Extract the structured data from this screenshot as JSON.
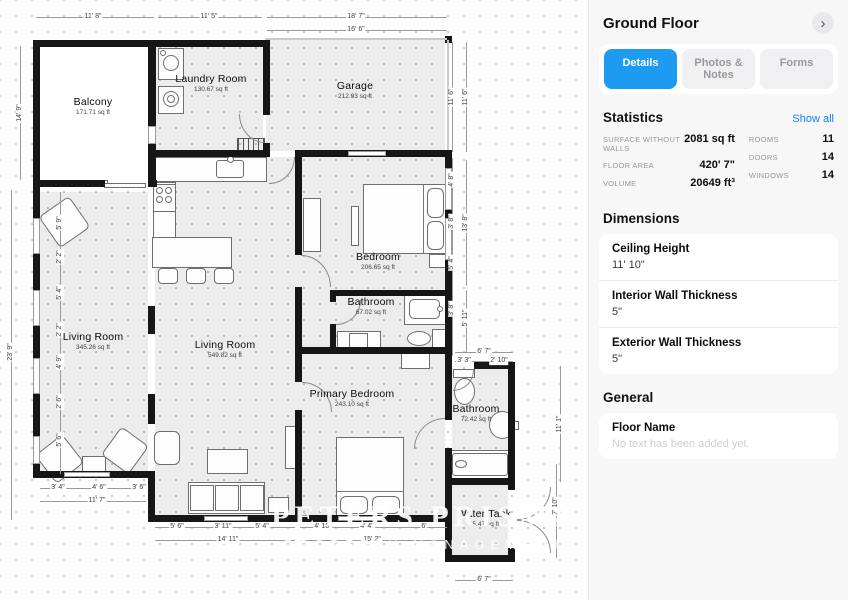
{
  "panel": {
    "title": "Ground Floor",
    "chevron_icon": "›",
    "accent_color": "#1d9bf0",
    "tabs": [
      {
        "label": "Details",
        "active": true
      },
      {
        "label": "Photos & Notes",
        "active": false
      },
      {
        "label": "Forms",
        "active": false
      }
    ],
    "statistics": {
      "heading": "Statistics",
      "show_all": "Show all",
      "left": [
        {
          "label": "SURFACE WITHOUT WALLS",
          "value": "2081 sq ft"
        },
        {
          "label": "FLOOR AREA",
          "value": "420' 7\""
        },
        {
          "label": "VOLUME",
          "value": "20649 ft³"
        }
      ],
      "right": [
        {
          "label": "ROOMS",
          "value": "11"
        },
        {
          "label": "DOORS",
          "value": "14"
        },
        {
          "label": "WINDOWS",
          "value": "14"
        }
      ]
    },
    "dimensions": {
      "heading": "Dimensions",
      "rows": [
        {
          "label": "Ceiling Height",
          "value": "11' 10\""
        },
        {
          "label": "Interior Wall Thickness",
          "value": "5\""
        },
        {
          "label": "Exterior Wall Thickness",
          "value": "5\""
        }
      ]
    },
    "general": {
      "heading": "General",
      "rows": [
        {
          "label": "Floor Name",
          "placeholder": "No text has been added yet."
        }
      ]
    }
  },
  "floor_plan": {
    "watermark": {
      "line1": "PETERS PRISMA",
      "line2": "PROPERTY MANAGEMENT"
    },
    "room_labels": [
      {
        "name": "Balcony",
        "area": "171.71 sq ft",
        "x": 93,
        "y": 106
      },
      {
        "name": "Laundry Room",
        "area": "130.67 sq ft",
        "x": 211,
        "y": 83
      },
      {
        "name": "Garage",
        "area": "212.93 sq ft",
        "x": 355,
        "y": 90
      },
      {
        "name": "Bedroom",
        "area": "206.65 sq ft",
        "x": 378,
        "y": 261
      },
      {
        "name": "Bathroom",
        "area": "67.02 sq ft",
        "x": 371,
        "y": 306
      },
      {
        "name": "Living Room",
        "area": "345.26 sq ft",
        "x": 93,
        "y": 341
      },
      {
        "name": "Living Room",
        "area": "549.82 sq ft",
        "x": 225,
        "y": 349
      },
      {
        "name": "Primary Bedroom",
        "area": "243.10 sq ft",
        "x": 352,
        "y": 398
      },
      {
        "name": "Bathroom",
        "area": "72.42 sq ft",
        "x": 476,
        "y": 413
      },
      {
        "name": "Water Tank",
        "area": "55.47 sq ft",
        "x": 484,
        "y": 518
      }
    ],
    "gray_areas": [
      [
        156,
        47,
        107,
        104
      ],
      [
        266,
        40,
        179,
        111
      ],
      [
        155,
        157,
        147,
        358
      ],
      [
        302,
        157,
        143,
        190
      ],
      [
        302,
        354,
        143,
        161
      ],
      [
        40,
        192,
        108,
        279
      ],
      [
        452,
        369,
        56,
        109
      ],
      [
        452,
        485,
        56,
        70
      ]
    ],
    "balcony_floor": [
      40,
      47,
      108,
      133
    ],
    "stairs": [
      237,
      138,
      28,
      18
    ],
    "walls": [
      [
        33,
        40,
        124,
        7
      ],
      [
        155,
        40,
        112,
        7
      ],
      [
        33,
        40,
        7,
        147
      ],
      [
        33,
        180,
        72,
        7
      ],
      [
        148,
        180,
        9,
        7
      ],
      [
        148,
        47,
        8,
        133
      ],
      [
        263,
        40,
        7,
        75
      ],
      [
        263,
        143,
        7,
        14
      ],
      [
        150,
        150,
        119,
        7
      ],
      [
        295,
        150,
        157,
        7
      ],
      [
        445,
        36,
        7,
        7
      ],
      [
        33,
        185,
        7,
        293
      ],
      [
        33,
        471,
        121,
        7
      ],
      [
        148,
        471,
        7,
        51
      ],
      [
        148,
        515,
        301,
        7
      ],
      [
        295,
        150,
        7,
        105
      ],
      [
        295,
        287,
        7,
        66
      ],
      [
        445,
        150,
        7,
        212
      ],
      [
        330,
        290,
        120,
        6
      ],
      [
        330,
        290,
        6,
        12
      ],
      [
        330,
        324,
        6,
        29
      ],
      [
        295,
        347,
        152,
        7
      ],
      [
        295,
        347,
        7,
        35
      ],
      [
        295,
        410,
        7,
        112
      ],
      [
        445,
        362,
        7,
        58
      ],
      [
        445,
        448,
        7,
        74
      ],
      [
        445,
        362,
        7,
        7
      ],
      [
        474,
        362,
        41,
        7
      ],
      [
        508,
        362,
        7,
        100
      ],
      [
        445,
        478,
        70,
        7
      ],
      [
        445,
        478,
        7,
        84
      ],
      [
        445,
        555,
        70,
        7
      ],
      [
        508,
        478,
        7,
        12
      ],
      [
        508,
        548,
        7,
        14
      ],
      [
        508,
        455,
        7,
        28
      ],
      [
        148,
        306,
        7,
        28
      ],
      [
        148,
        394,
        7,
        30
      ]
    ],
    "light_lines": [
      [
        265,
        38,
        182,
        2
      ],
      [
        447,
        40,
        2,
        110
      ]
    ],
    "windows": [
      [
        33,
        218,
        7,
        36
      ],
      [
        33,
        290,
        7,
        36
      ],
      [
        33,
        358,
        7,
        36
      ],
      [
        33,
        436,
        7,
        28
      ],
      [
        64,
        472,
        46,
        5
      ],
      [
        148,
        126,
        8,
        18
      ],
      [
        348,
        151,
        38,
        5
      ],
      [
        445,
        168,
        7,
        42
      ],
      [
        445,
        218,
        7,
        42
      ],
      [
        204,
        516,
        44,
        5
      ],
      [
        338,
        516,
        44,
        5
      ]
    ],
    "doors": [
      {
        "x": 239,
        "y": 114,
        "w": 26,
        "h": 29,
        "c": "bl"
      },
      {
        "x": 269,
        "y": 157,
        "w": 26,
        "h": 27,
        "c": "br"
      },
      {
        "x": 301,
        "y": 255,
        "w": 30,
        "h": 32,
        "c": "tr"
      },
      {
        "x": 336,
        "y": 300,
        "w": 25,
        "h": 25,
        "c": "br"
      },
      {
        "x": 302,
        "y": 382,
        "w": 30,
        "h": 30,
        "c": "tr"
      },
      {
        "x": 414,
        "y": 418,
        "w": 31,
        "h": 31,
        "c": "tl"
      },
      {
        "x": 453,
        "y": 370,
        "w": 21,
        "h": 21,
        "c": "br"
      },
      {
        "x": 517,
        "y": 487,
        "w": 34,
        "h": 33,
        "c": "br"
      },
      {
        "x": 517,
        "y": 520,
        "w": 34,
        "h": 33,
        "c": "tr"
      }
    ],
    "furniture": [
      {
        "x": 158,
        "y": 48,
        "w": 26,
        "h": 32
      },
      {
        "x": 163,
        "y": 55,
        "w": 16,
        "h": 16,
        "e": 1
      },
      {
        "x": 160,
        "y": 50,
        "w": 6,
        "h": 6,
        "e": 1
      },
      {
        "x": 158,
        "y": 86,
        "w": 26,
        "h": 28
      },
      {
        "x": 163,
        "y": 91,
        "w": 16,
        "h": 16,
        "e": 1
      },
      {
        "x": 167,
        "y": 95,
        "w": 8,
        "h": 8,
        "e": 1
      },
      {
        "x": 153,
        "y": 157,
        "w": 114,
        "h": 25
      },
      {
        "x": 216,
        "y": 160,
        "w": 28,
        "h": 18,
        "r": 3
      },
      {
        "x": 227,
        "y": 156,
        "w": 7,
        "h": 7,
        "e": 1
      },
      {
        "x": 153,
        "y": 182,
        "w": 23,
        "h": 74
      },
      {
        "x": 153,
        "y": 184,
        "w": 23,
        "h": 28
      },
      {
        "x": 156,
        "y": 187,
        "w": 7,
        "h": 7,
        "e": 1
      },
      {
        "x": 165,
        "y": 187,
        "w": 7,
        "h": 7,
        "e": 1
      },
      {
        "x": 156,
        "y": 196,
        "w": 7,
        "h": 7,
        "e": 1
      },
      {
        "x": 165,
        "y": 196,
        "w": 7,
        "h": 7,
        "e": 1
      },
      {
        "x": 152,
        "y": 237,
        "w": 80,
        "h": 31
      },
      {
        "x": 158,
        "y": 268,
        "w": 20,
        "h": 16,
        "r": 4
      },
      {
        "x": 186,
        "y": 268,
        "w": 20,
        "h": 16,
        "r": 4
      },
      {
        "x": 214,
        "y": 268,
        "w": 20,
        "h": 16,
        "r": 4
      },
      {
        "x": 363,
        "y": 184,
        "w": 83,
        "h": 70
      },
      {
        "x": 427,
        "y": 188,
        "w": 17,
        "h": 30,
        "r": 6
      },
      {
        "x": 427,
        "y": 221,
        "w": 17,
        "h": 29,
        "r": 6
      },
      {
        "x": 351,
        "y": 206,
        "w": 8,
        "h": 40
      },
      {
        "x": 429,
        "y": 254,
        "w": 18,
        "h": 14
      },
      {
        "x": 303,
        "y": 198,
        "w": 18,
        "h": 54
      },
      {
        "x": 404,
        "y": 295,
        "w": 43,
        "h": 30
      },
      {
        "x": 409,
        "y": 299,
        "w": 31,
        "h": 20,
        "r": 5
      },
      {
        "x": 437,
        "y": 306,
        "w": 6,
        "h": 6,
        "e": 1
      },
      {
        "x": 407,
        "y": 331,
        "w": 24,
        "h": 15,
        "e": 1
      },
      {
        "x": 432,
        "y": 329,
        "w": 14,
        "h": 19
      },
      {
        "x": 337,
        "y": 331,
        "w": 44,
        "h": 21
      },
      {
        "x": 349,
        "y": 333,
        "w": 19,
        "h": 17
      },
      {
        "x": 401,
        "y": 353,
        "w": 29,
        "h": 16
      },
      {
        "x": 336,
        "y": 437,
        "w": 68,
        "h": 79
      },
      {
        "x": 340,
        "y": 496,
        "w": 28,
        "h": 18,
        "r": 6
      },
      {
        "x": 372,
        "y": 496,
        "w": 28,
        "h": 18,
        "r": 6
      },
      {
        "x": 453,
        "y": 369,
        "w": 22,
        "h": 9
      },
      {
        "x": 454,
        "y": 378,
        "w": 21,
        "h": 27,
        "e": 1
      },
      {
        "x": 489,
        "y": 411,
        "w": 27,
        "h": 28,
        "e": 1
      },
      {
        "x": 513,
        "y": 421,
        "w": 6,
        "h": 9
      },
      {
        "x": 449,
        "y": 450,
        "w": 62,
        "h": 29
      },
      {
        "x": 452,
        "y": 453,
        "w": 56,
        "h": 23,
        "r": 3
      },
      {
        "x": 455,
        "y": 460,
        "w": 12,
        "h": 8,
        "e": 1
      },
      {
        "x": 188,
        "y": 482,
        "w": 77,
        "h": 32
      },
      {
        "x": 190,
        "y": 485,
        "w": 24,
        "h": 26
      },
      {
        "x": 215,
        "y": 485,
        "w": 24,
        "h": 26
      },
      {
        "x": 240,
        "y": 485,
        "w": 24,
        "h": 26
      },
      {
        "x": 268,
        "y": 497,
        "w": 21,
        "h": 16
      },
      {
        "x": 207,
        "y": 449,
        "w": 41,
        "h": 25
      },
      {
        "x": 42,
        "y": 441,
        "w": 35,
        "h": 36,
        "o": -38,
        "r": 5
      },
      {
        "x": 82,
        "y": 456,
        "w": 24,
        "h": 20
      },
      {
        "x": 108,
        "y": 433,
        "w": 34,
        "h": 35,
        "o": 36,
        "r": 5
      },
      {
        "x": 154,
        "y": 431,
        "w": 26,
        "h": 34,
        "r": 6
      },
      {
        "x": 46,
        "y": 203,
        "w": 37,
        "h": 38,
        "o": -35,
        "r": 5
      },
      {
        "x": 285,
        "y": 426,
        "w": 15,
        "h": 43
      },
      {
        "x": 70,
        "y": 180,
        "w": 38,
        "h": 5
      },
      {
        "x": 104,
        "y": 183,
        "w": 42,
        "h": 5
      }
    ],
    "fold_lines": [
      [
        423,
        185,
        1,
        69
      ],
      [
        337,
        491,
        67,
        1
      ]
    ],
    "dim_lines": [
      [
        36,
        17,
        118,
        1
      ],
      [
        158,
        17,
        104,
        1
      ],
      [
        267,
        17,
        180,
        1
      ],
      [
        267,
        30,
        180,
        1
      ],
      [
        20,
        46,
        1,
        134
      ],
      [
        11,
        190,
        1,
        330
      ],
      [
        60,
        192,
        1,
        282
      ],
      [
        452,
        42,
        1,
        110
      ],
      [
        466,
        42,
        1,
        110
      ],
      [
        452,
        158,
        1,
        198
      ],
      [
        466,
        160,
        1,
        126
      ],
      [
        452,
        294,
        1,
        52
      ],
      [
        466,
        290,
        1,
        62
      ],
      [
        455,
        352,
        58,
        1
      ],
      [
        455,
        361,
        58,
        1
      ],
      [
        560,
        366,
        1,
        116
      ],
      [
        556,
        464,
        1,
        94
      ],
      [
        455,
        580,
        58,
        1
      ],
      [
        40,
        488,
        106,
        1
      ],
      [
        40,
        501,
        106,
        1
      ],
      [
        155,
        527,
        140,
        1
      ],
      [
        155,
        540,
        140,
        1
      ],
      [
        300,
        527,
        147,
        1
      ],
      [
        300,
        540,
        147,
        1
      ]
    ],
    "dim_labels": [
      {
        "t": "11' 8\"",
        "x": 93,
        "y": 17
      },
      {
        "t": "11' 5\"",
        "x": 209,
        "y": 17
      },
      {
        "t": "18' 7\"",
        "x": 356,
        "y": 17
      },
      {
        "t": "16' 6\"",
        "x": 356,
        "y": 30
      },
      {
        "t": "14' 9\"",
        "x": 20,
        "y": 113,
        "r": 1
      },
      {
        "t": "23' 9\"",
        "x": 11,
        "y": 352,
        "r": 1
      },
      {
        "t": "5' 9\"",
        "x": 60,
        "y": 223,
        "r": 1
      },
      {
        "t": "2' 2\"",
        "x": 60,
        "y": 257,
        "r": 1
      },
      {
        "t": "5' 4\"",
        "x": 60,
        "y": 293,
        "r": 1
      },
      {
        "t": "2' 2\"",
        "x": 60,
        "y": 330,
        "r": 1
      },
      {
        "t": "4' 9\"",
        "x": 60,
        "y": 362,
        "r": 1
      },
      {
        "t": "2' 6\"",
        "x": 60,
        "y": 402,
        "r": 1
      },
      {
        "t": "5' 6\"",
        "x": 60,
        "y": 440,
        "r": 1
      },
      {
        "t": "11' 6\"",
        "x": 452,
        "y": 97,
        "r": 1
      },
      {
        "t": "11' 6\"",
        "x": 466,
        "y": 97,
        "r": 1
      },
      {
        "t": "4' 8\"",
        "x": 452,
        "y": 180,
        "r": 1
      },
      {
        "t": "3' 8\"",
        "x": 452,
        "y": 222,
        "r": 1
      },
      {
        "t": "5' 4\"",
        "x": 452,
        "y": 263,
        "r": 1
      },
      {
        "t": "13' 8\"",
        "x": 466,
        "y": 223,
        "r": 1
      },
      {
        "t": "3' 8\"",
        "x": 452,
        "y": 309,
        "r": 1
      },
      {
        "t": "5' 11\"",
        "x": 466,
        "y": 318,
        "r": 1
      },
      {
        "t": "6' 7\"",
        "x": 484,
        "y": 352
      },
      {
        "t": "3' 3\"",
        "x": 464,
        "y": 361
      },
      {
        "t": "2' 10\"",
        "x": 499,
        "y": 361
      },
      {
        "t": "11' 1\"",
        "x": 560,
        "y": 424,
        "r": 1
      },
      {
        "t": "7' 10\"",
        "x": 556,
        "y": 506,
        "r": 1
      },
      {
        "t": "3' 4\"",
        "x": 58,
        "y": 488
      },
      {
        "t": "4' 6\"",
        "x": 99,
        "y": 488
      },
      {
        "t": "3' 6\"",
        "x": 139,
        "y": 488
      },
      {
        "t": "11' 7\"",
        "x": 97,
        "y": 501
      },
      {
        "t": "5' 6\"",
        "x": 177,
        "y": 527
      },
      {
        "t": "3' 11\"",
        "x": 223,
        "y": 527
      },
      {
        "t": "5' 4\"",
        "x": 262,
        "y": 527
      },
      {
        "t": "14' 11\"",
        "x": 228,
        "y": 540
      },
      {
        "t": "4' 10\"",
        "x": 323,
        "y": 527
      },
      {
        "t": "4' 4\"",
        "x": 367,
        "y": 527
      },
      {
        "t": "6'",
        "x": 424,
        "y": 527
      },
      {
        "t": "15' 2\"",
        "x": 372,
        "y": 540
      },
      {
        "t": "6' 7\"",
        "x": 484,
        "y": 580
      }
    ]
  }
}
